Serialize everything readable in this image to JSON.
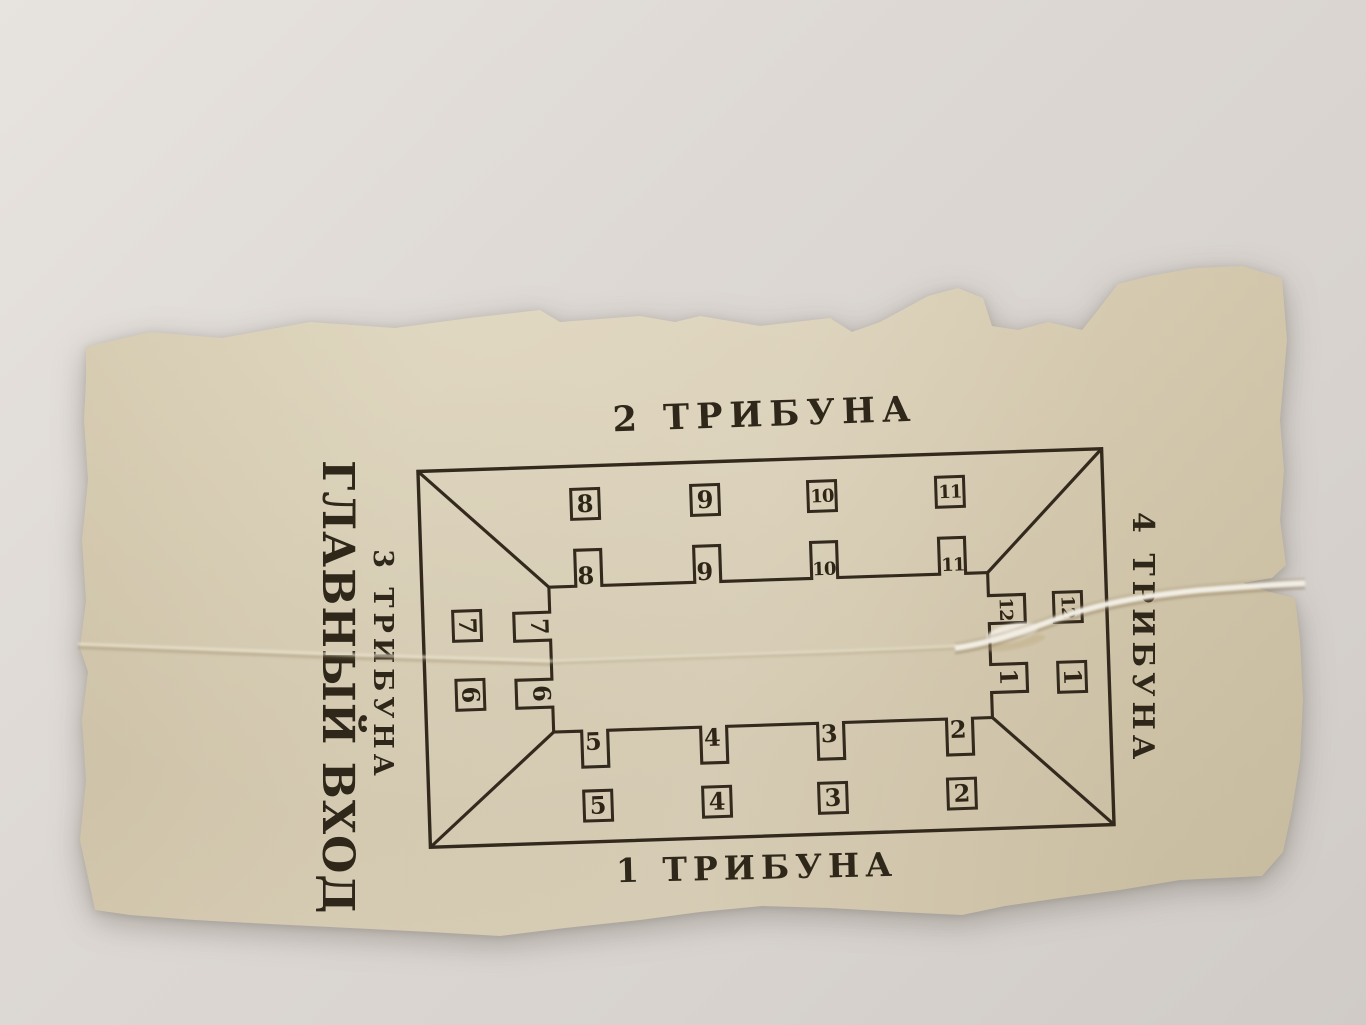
{
  "colors": {
    "background": "#dad5d1",
    "paper": "#d8cdb3",
    "ink": "#2f2719"
  },
  "ticket": {
    "stands": {
      "top": "2 ТРИБУНА",
      "bottom": "1 ТРИБУНА",
      "left_line1": "3 ТРИБУНА",
      "left_line2": "ГЛАВНЫЙ ВХОД",
      "right": "4 ТРИБУНА"
    },
    "plan": {
      "top": [
        {
          "gate": "8",
          "box": "8"
        },
        {
          "gate": "9",
          "box": "9"
        },
        {
          "gate": "10",
          "box": "10"
        },
        {
          "gate": "11",
          "box": "11"
        }
      ],
      "bottom": [
        {
          "gate": "5",
          "box": "5"
        },
        {
          "gate": "4",
          "box": "4"
        },
        {
          "gate": "3",
          "box": "3"
        },
        {
          "gate": "2",
          "box": "2"
        }
      ],
      "left": [
        {
          "gate": "7",
          "box": "7"
        },
        {
          "gate": "6",
          "box": "6"
        }
      ],
      "right": [
        {
          "gate": "12",
          "box": "12"
        },
        {
          "gate": "1",
          "box": "1"
        }
      ]
    }
  }
}
